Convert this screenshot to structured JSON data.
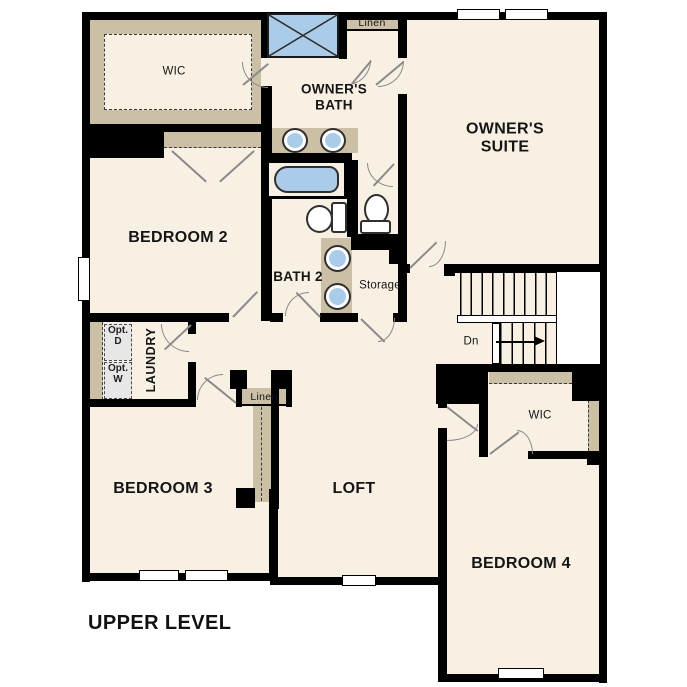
{
  "labels": {
    "wic_upper_left": "WIC",
    "owners_bath": "OWNER'S\nBATH",
    "linen_upper": "Linen",
    "owners_suite": "OWNER'S\nSUITE",
    "bedroom2": "BEDROOM 2",
    "bath2": "BATH 2",
    "storage": "Storage",
    "laundry": "LAUNDRY",
    "opt_dryer": "Opt.\nD",
    "opt_washer": "Opt.\nW",
    "bedroom3": "BEDROOM 3",
    "linen_hall": "Linen",
    "loft": "LOFT",
    "wic_bedroom4": "WIC",
    "bedroom4": "BEDROOM 4",
    "stairs_down": "Dn",
    "level_title": "UPPER LEVEL"
  },
  "colors": {
    "wall": "#000000",
    "floor": "#f8f0e3",
    "casework": "#cbbfa6",
    "fixture": "#abcce9",
    "option_fill": "#e7e7e7",
    "door": "#8a8a8a"
  }
}
